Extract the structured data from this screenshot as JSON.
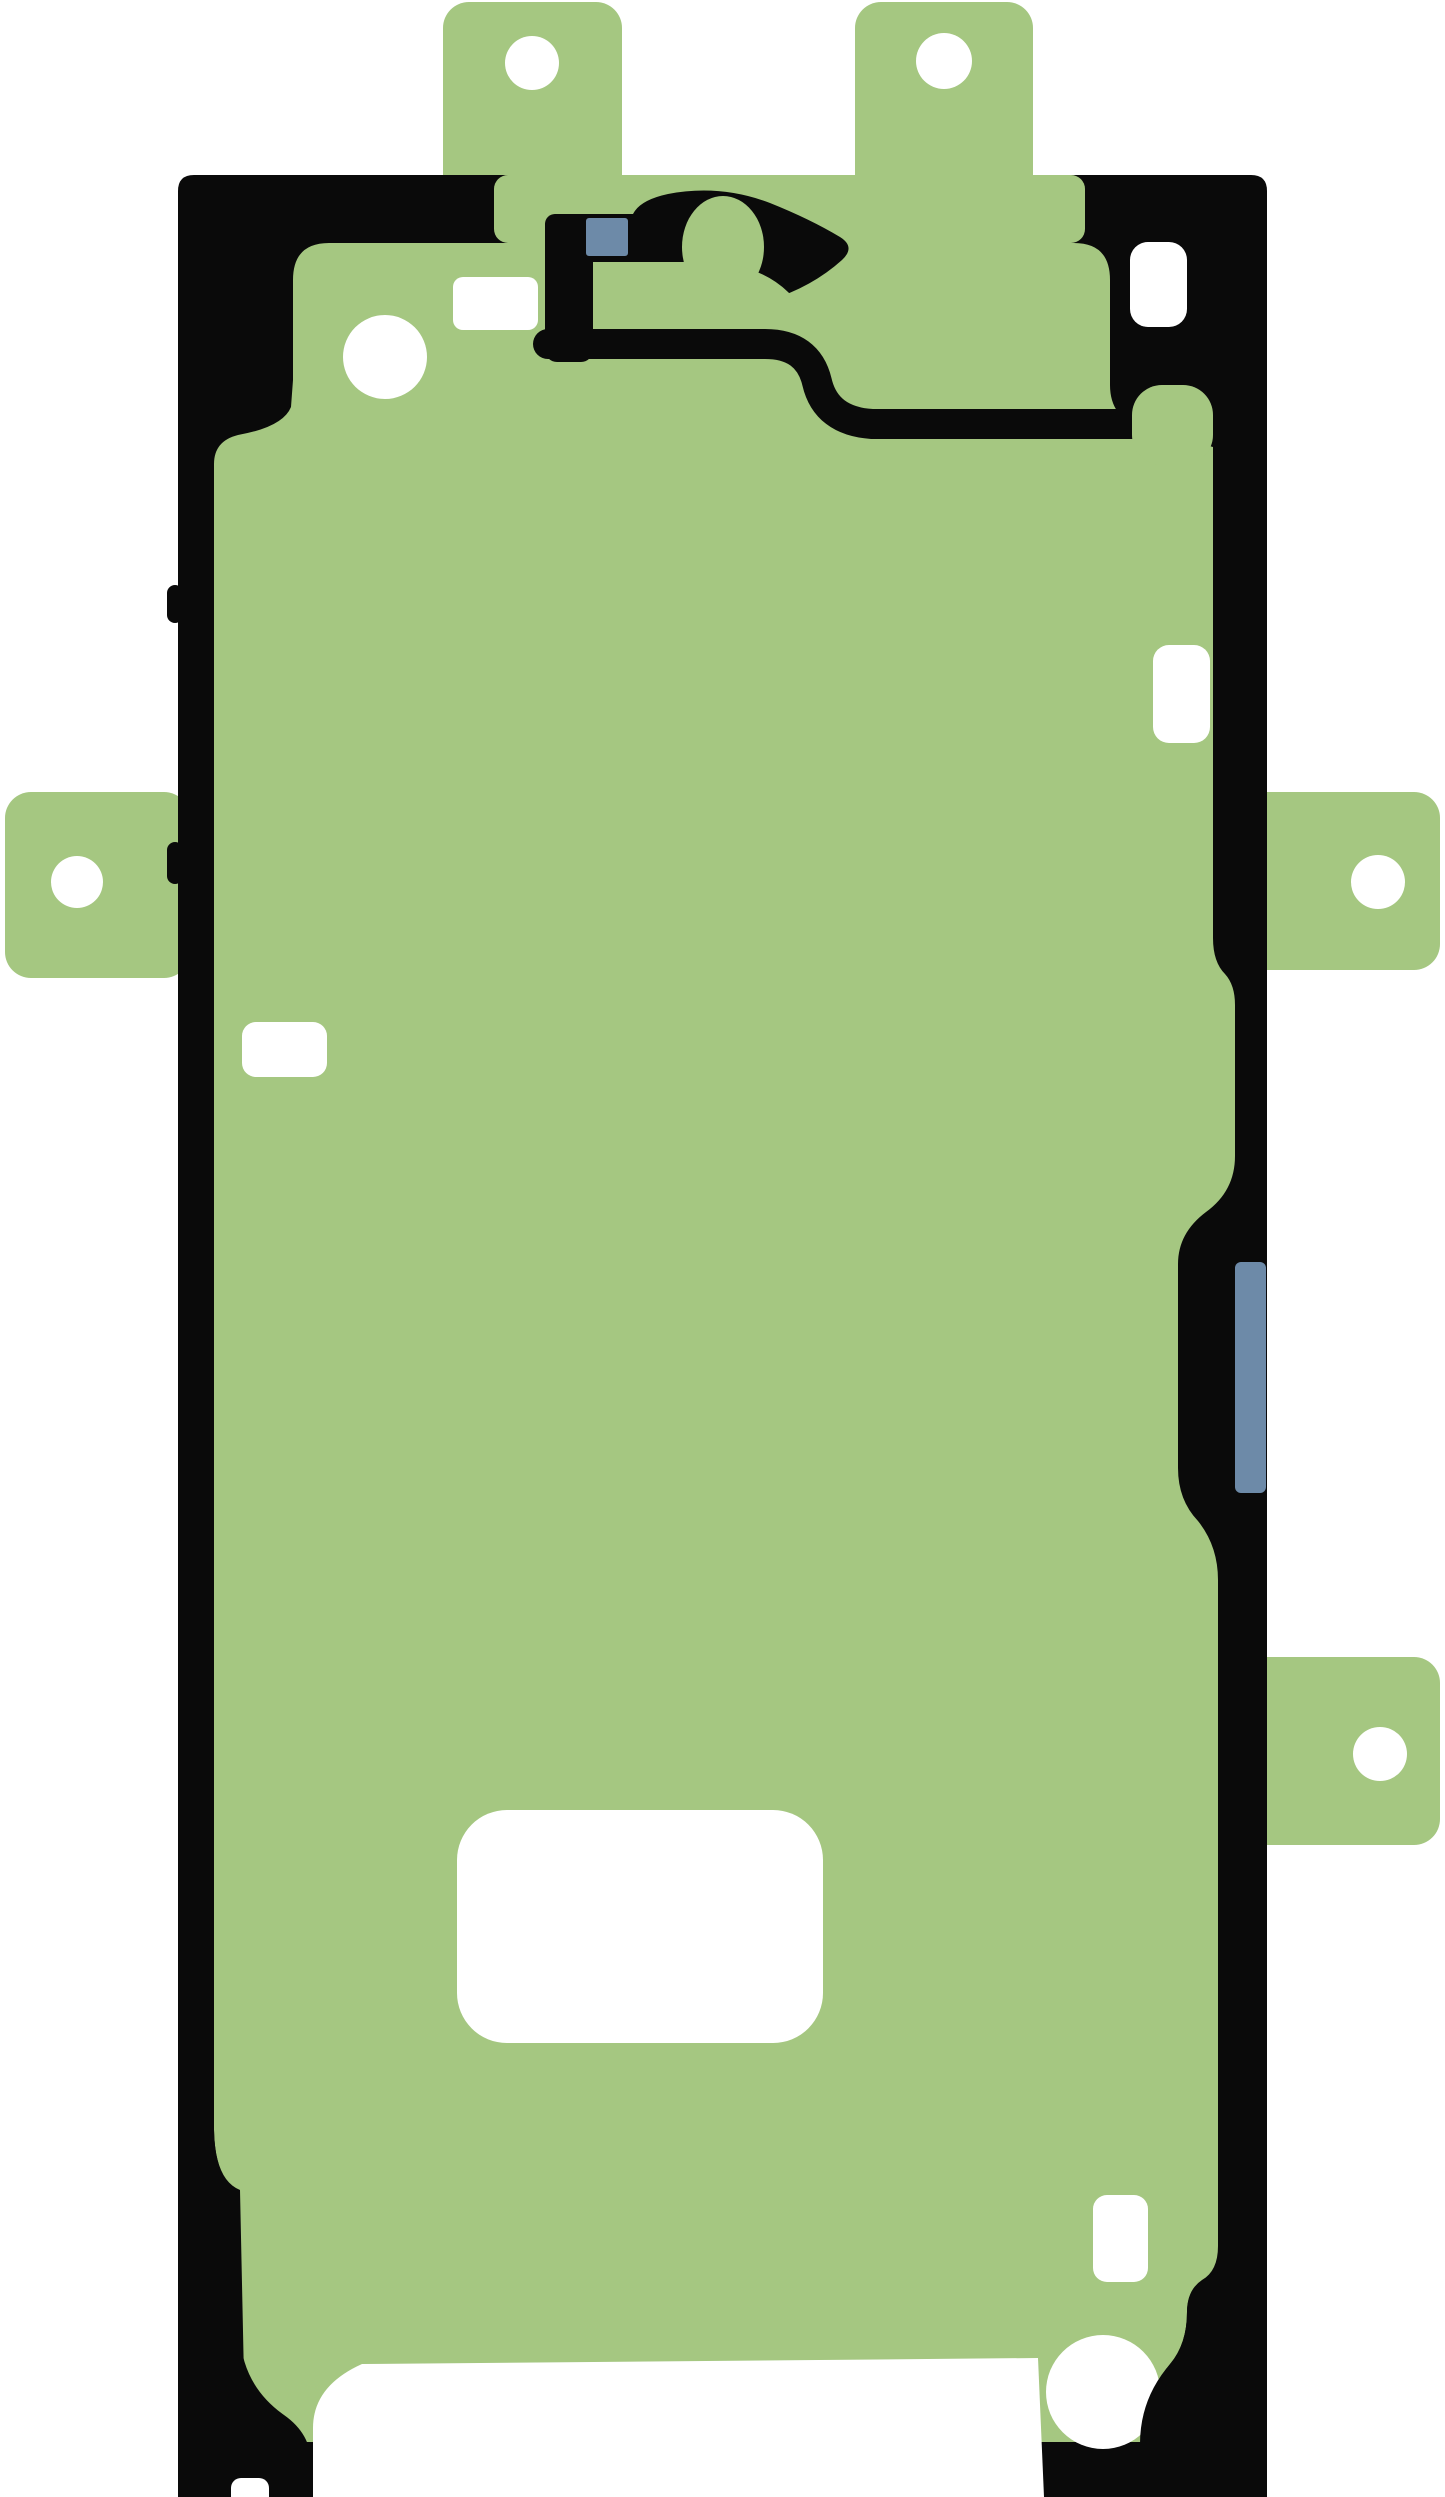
{
  "image": {
    "kind": "product-photo",
    "subject": "smartphone display adhesive sticker with green protective liner",
    "orientation": "portrait"
  },
  "colors": {
    "background": "#ffffff",
    "liner_green": "#a5c781",
    "outline_black": "#0a0a0a",
    "marker_blue": "#6d8aa8",
    "cutout_white": "#ffffff"
  },
  "parts": {
    "body_label": "adhesive outline body",
    "tab_count": 5,
    "tab_hole_count": 5,
    "white_cutout_count": 8,
    "blue_marker_count": 2,
    "camera_label": "camera cutout",
    "tabs": [
      {
        "id": "top-left-tab"
      },
      {
        "id": "top-right-tab"
      },
      {
        "id": "left-side-tab"
      },
      {
        "id": "right-middle-tab"
      },
      {
        "id": "right-lower-tab"
      }
    ]
  }
}
